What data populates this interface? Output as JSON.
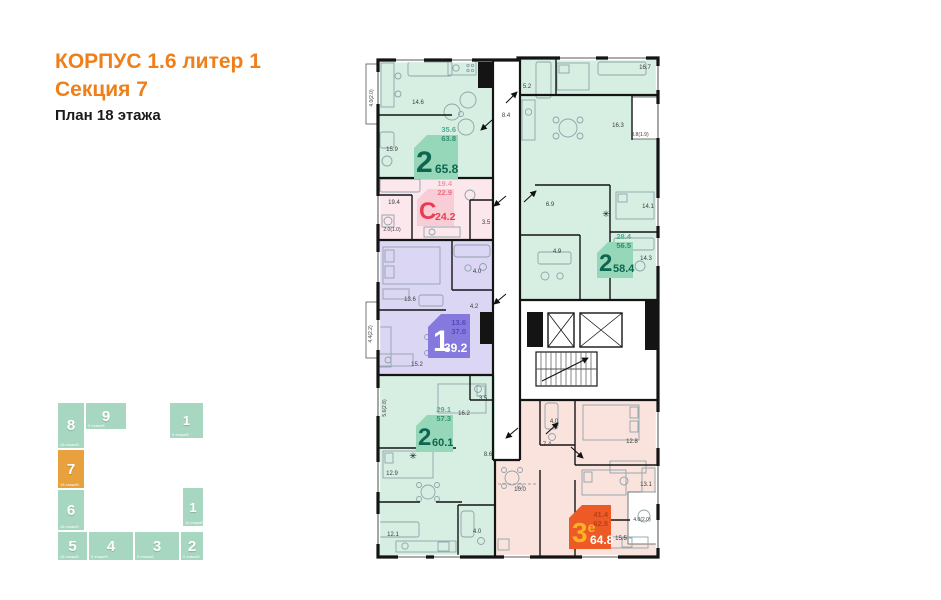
{
  "header": {
    "building": "КОРПУС 1.6 литер 1",
    "section": "Секция 7",
    "plan_title": "План 18 этажа",
    "accent_color": "#ef7f1a"
  },
  "plan": {
    "wall_color": "#141414",
    "vent_icon": "✳",
    "apartments": [
      {
        "name": "2-room 65.8",
        "type_label": "2",
        "type_sup": "",
        "total_area": "65.8",
        "living_area": "35.6",
        "area_no_loggia": "63.8",
        "region_color": "#d7efe2",
        "badge_color": "#97d7b9",
        "type_color": "#0d6750",
        "area_color": "#0d6750",
        "sub1_color": "#4fae8e",
        "sub2_color": "#2f9070",
        "rooms": [
          "14.6",
          "15.9",
          "8.4",
          "5.2",
          "16.7",
          "4.0(2.0)"
        ]
      },
      {
        "name": "studio 24.2",
        "type_label": "С",
        "type_sup": "",
        "total_area": "24.2",
        "living_area": "19.4",
        "area_no_loggia": "22.9",
        "region_color": "#fbe7ec",
        "badge_color": "#f8cdd6",
        "type_color": "#e73c52",
        "area_color": "#e73c52",
        "sub1_color": "#f09aa8",
        "sub2_color": "#ea7184",
        "rooms": [
          "19.4",
          "3.5",
          "2.0(1.0)"
        ]
      },
      {
        "name": "2-room 58.4",
        "type_label": "2",
        "type_sup": "",
        "total_area": "58.4",
        "living_area": "28.4",
        "area_no_loggia": "56.5",
        "region_color": "#d7efe2",
        "badge_color": "#97d7b9",
        "type_color": "#0d6750",
        "area_color": "#0d6750",
        "sub1_color": "#4fae8e",
        "sub2_color": "#2f9070",
        "rooms": [
          "16.3",
          "14.1",
          "14.3",
          "6.9",
          "4.9",
          "3.8(1.9)"
        ]
      },
      {
        "name": "1-room 39.2",
        "type_label": "1",
        "type_sup": "",
        "total_area": "39.2",
        "living_area": "13.6",
        "area_no_loggia": "37.0",
        "region_color": "#dcd6f5",
        "badge_color": "#8679de",
        "type_color": "#ffffff",
        "area_color": "#ffffff",
        "sub1_color": "#5448bd",
        "sub2_color": "#5448bd",
        "rooms": [
          "13.6",
          "4.0",
          "4.2",
          "15.2",
          "4.4(2.2)"
        ]
      },
      {
        "name": "2-room 60.1",
        "type_label": "2",
        "type_sup": "",
        "total_area": "60.1",
        "living_area": "29.1",
        "area_no_loggia": "57.3",
        "region_color": "#d7efe2",
        "badge_color": "#97d7b9",
        "type_color": "#0d6750",
        "area_color": "#0d6750",
        "sub1_color": "#4fae8e",
        "sub2_color": "#2f9070",
        "rooms": [
          "3.5",
          "16.2",
          "5.6(2.8)",
          "12.9",
          "8.6",
          "12.1",
          "4.0"
        ]
      },
      {
        "name": "3-room euro 64.8",
        "type_label": "3",
        "type_sup": "е",
        "total_area": "64.8",
        "living_area": "41.4",
        "area_no_loggia": "62.8",
        "region_color": "#fae3dc",
        "badge_color": "#ee5a26",
        "type_color": "#f9b324",
        "area_color": "#ffffff",
        "sub1_color": "#bb4116",
        "sub2_color": "#bb4116",
        "rooms": [
          "4.0",
          "7.4",
          "12.8",
          "13.1",
          "10.0",
          "15.5",
          "4.0(2.0)"
        ]
      }
    ]
  },
  "section_map": {
    "block_color": "#a7d7c1",
    "active_color": "#e8a13c",
    "blocks": [
      {
        "num": "8",
        "floors": "18 этажей"
      },
      {
        "num": "9",
        "floors": "9 этажей"
      },
      {
        "num": "1",
        "floors": "9 этажей"
      },
      {
        "num": "7",
        "floors": "18 этажей"
      },
      {
        "num": "6",
        "floors": "18 этажей"
      },
      {
        "num": "1",
        "floors": "18 этажей"
      },
      {
        "num": "5",
        "floors": "18 этажей"
      },
      {
        "num": "4",
        "floors": "9 этажей"
      },
      {
        "num": "3",
        "floors": "9 этажей"
      },
      {
        "num": "2",
        "floors": "9 этажей"
      }
    ]
  }
}
